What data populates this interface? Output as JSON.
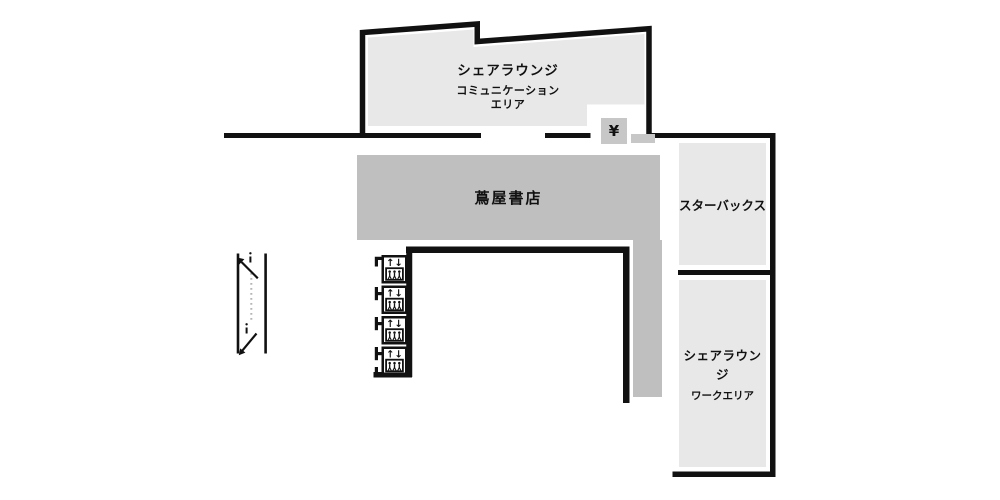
{
  "floor_map": {
    "areas": {
      "share_lounge_communication": {
        "title": "シェアラウンジ",
        "subtitle_line1": "コミュニケーション",
        "subtitle_line2": "エリア"
      },
      "tsutaya_books": {
        "label": "蔦屋書店"
      },
      "starbucks": {
        "label": "スターバックス"
      },
      "share_lounge_work": {
        "title": "シェアラウンジ",
        "subtitle": "ワークエリア"
      },
      "pay_machine": {
        "label": "¥"
      }
    },
    "icons": {
      "elevator": {
        "name": "elevator",
        "count": 4,
        "arrows": "↑↓"
      },
      "escalator": {
        "name": "escalator"
      }
    },
    "colors": {
      "wall": "#111111",
      "area_light": "#e8e8e8",
      "area_mid": "#c7c7c7",
      "bookstore": "#bfbfbf",
      "background": "#ffffff"
    }
  }
}
